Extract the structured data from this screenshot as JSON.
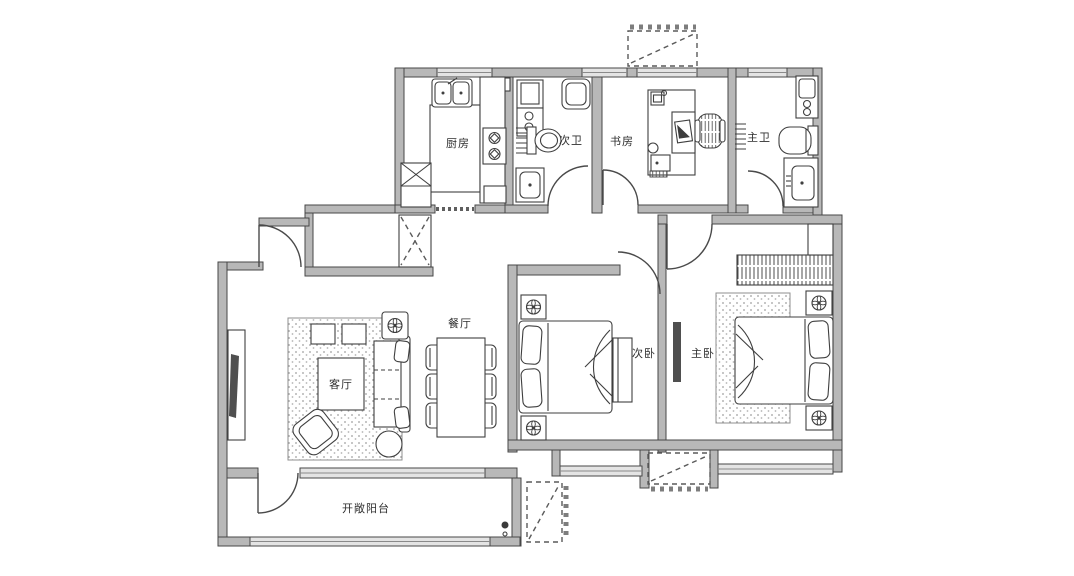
{
  "page": {
    "background": "#ffffff",
    "type": "apartment-floor-plan"
  },
  "palette": {
    "wall_fill": "#b8b8b8",
    "wall_line": "#474747",
    "window_fill": "#e4e4e4",
    "furniture_line": "#3f3f3f",
    "label_color": "#2e2e2e",
    "tv_fill": "#4f4f4f"
  },
  "rooms": {
    "kitchen": {
      "label": "厨房"
    },
    "second_bath": {
      "label": "次卫"
    },
    "study": {
      "label": "书房"
    },
    "master_bath": {
      "label": "主卫"
    },
    "dining": {
      "label": "餐厅"
    },
    "living": {
      "label": "客厅"
    },
    "second_bedroom": {
      "label": "次卧"
    },
    "master_bedroom": {
      "label": "主卧"
    },
    "balcony": {
      "label": "开敞阳台"
    }
  }
}
